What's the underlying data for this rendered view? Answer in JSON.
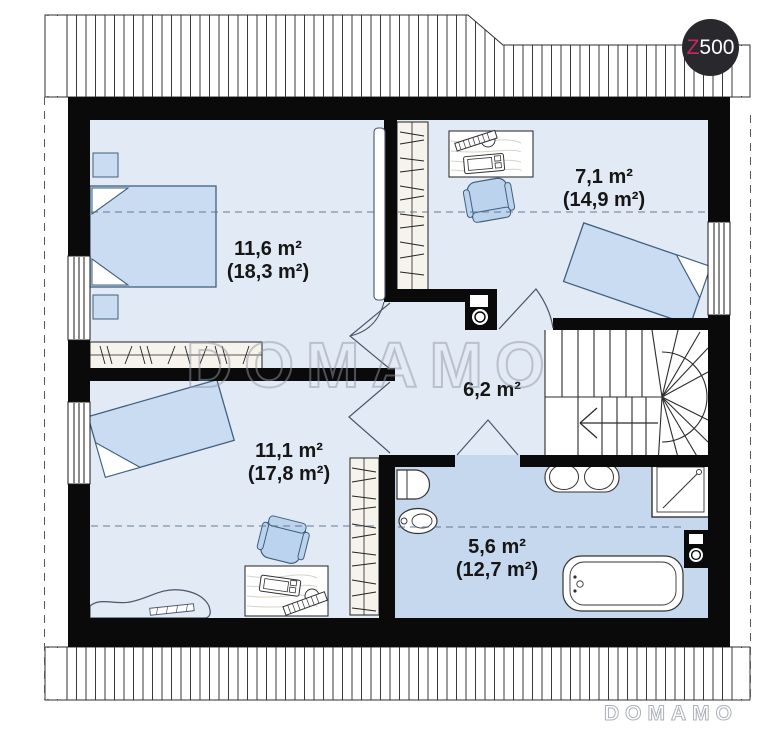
{
  "plan": {
    "type": "floor-plan-attic",
    "rooms": [
      {
        "id": "bedroom-top-left",
        "area": "11,6 m²",
        "total": "(18,3 m²)"
      },
      {
        "id": "bedroom-top-right",
        "area": "7,1 m²",
        "total": "(14,9 m²)"
      },
      {
        "id": "hall",
        "area": "6,2 m²",
        "total": ""
      },
      {
        "id": "bedroom-bottom-left",
        "area": "11,1 m²",
        "total": "(17,8 m²)"
      },
      {
        "id": "bathroom",
        "area": "5,6 m²",
        "total": "(12,7 m²)"
      }
    ]
  },
  "watermark": {
    "center": "DOMAMO",
    "corner": "DOMAMO"
  },
  "logo": {
    "prefix": "Z",
    "suffix": "500"
  },
  "colors": {
    "floor": "#e2eaf6",
    "bath": "#c5d8ee",
    "furn": "#c9dcf2",
    "furn2": "#bcd3ee",
    "wall": "#0a0a0a",
    "accent": "#c52862",
    "wood": "#d8d2c5",
    "cream": "#f6f3ec"
  }
}
